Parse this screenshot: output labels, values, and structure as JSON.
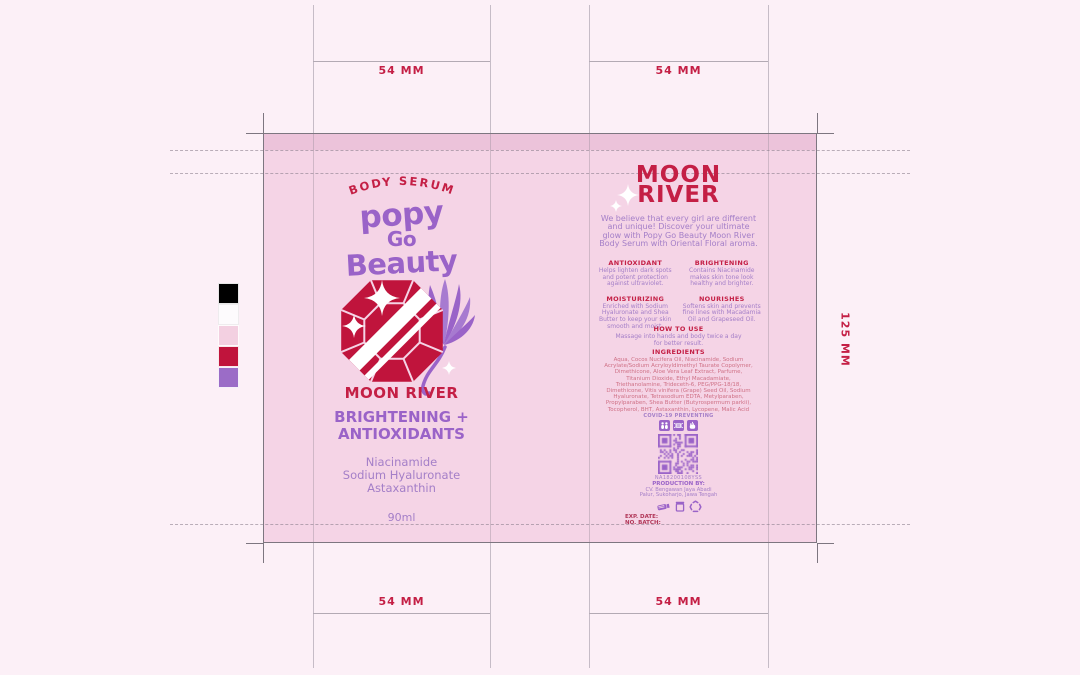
{
  "meta": {
    "artboard_bg": "#fcf0f7",
    "label_bg": "#f5d4e6",
    "label_band": "#ecc3da",
    "brand_red": "#c41f45",
    "brand_purple": "#9a63c8"
  },
  "dimensions": {
    "panel_width": "54 MM",
    "panel_height": "125 MM"
  },
  "swatches": {
    "black": "#000000",
    "white": "#fdfbfd",
    "pink": "#f3d0e1",
    "red": "#c0143c",
    "purple": "#9b6cc7"
  },
  "front_panel": {
    "tagline": "BODY SERUM",
    "logo_line1": "popy",
    "logo_line2": "Go",
    "logo_line3": "Beauty",
    "product_name": "MOON RIVER",
    "benefit_line1": "BRIGHTENING +",
    "benefit_line2": "ANTIOXIDANTS",
    "actives": [
      "Niacinamide",
      "Sodium Hyaluronate",
      "Astaxanthin"
    ],
    "volume": "90ml"
  },
  "back_panel": {
    "title_line1": "MOON",
    "title_line2": "RIVER",
    "description": "We believe that every girl are different and unique! Discover your ultimate glow with Popy Go Beauty Moon River Body Serum with Oriental Floral aroma.",
    "benefits": [
      {
        "title": "ANTIOXIDANT",
        "body": "Helps lighten dark spots and potent protection against ultraviolet."
      },
      {
        "title": "BRIGHTENING",
        "body": "Contains Niacinamide makes skin tone look healthy and brighter."
      },
      {
        "title": "MOISTURIZING",
        "body": "Enriched with Sodium Hyaluronate and Shea Butter to keep your skin smooth and moist."
      },
      {
        "title": "NOURISHES",
        "body": "Softens skin and prevents fine lines with Macadamia Oil and Grapeseed Oil."
      }
    ],
    "how_to_use": {
      "title": "HOW TO USE",
      "body": "Massage into hands and body twice a day for better result."
    },
    "ingredients": {
      "title": "INGREDIENTS",
      "body": "Aqua, Cocos Nucifera Oil, Niacinamide, Sodium Acrylate/Sodium Acryloyldimethyl Taurate Copolymer, Dimethicone, Aloe Vera Leaf Extract, Parfume, Titanium Dioxide, Ethyl Macadamiate, Triethanolamine, Trideceth-6, PEG/PPG-18/18, Dimethicone, Vitis vinifera (Grape) Seed Oil, Sodium Hyaluronate, Tetrasodium EDTA, Metylparaben, Propylparaben, Shea Butter (Butyrospermum parkii), Tocopherol, BHT, Astaxanthin, Lycopene, Malic Acid"
    },
    "covid_label": "COVID-19 PREVENTING",
    "qr_code_text": "NA18200108YSS",
    "production_label": "PRODUCTION BY:",
    "production_line1": "CV. Bengawan Jaya Abadi",
    "production_line2": "Palur, Sukoharjo, Jawa Tengah",
    "exp_date_label": "EXP. DATE:",
    "batch_label": "NO. BATCH:"
  }
}
